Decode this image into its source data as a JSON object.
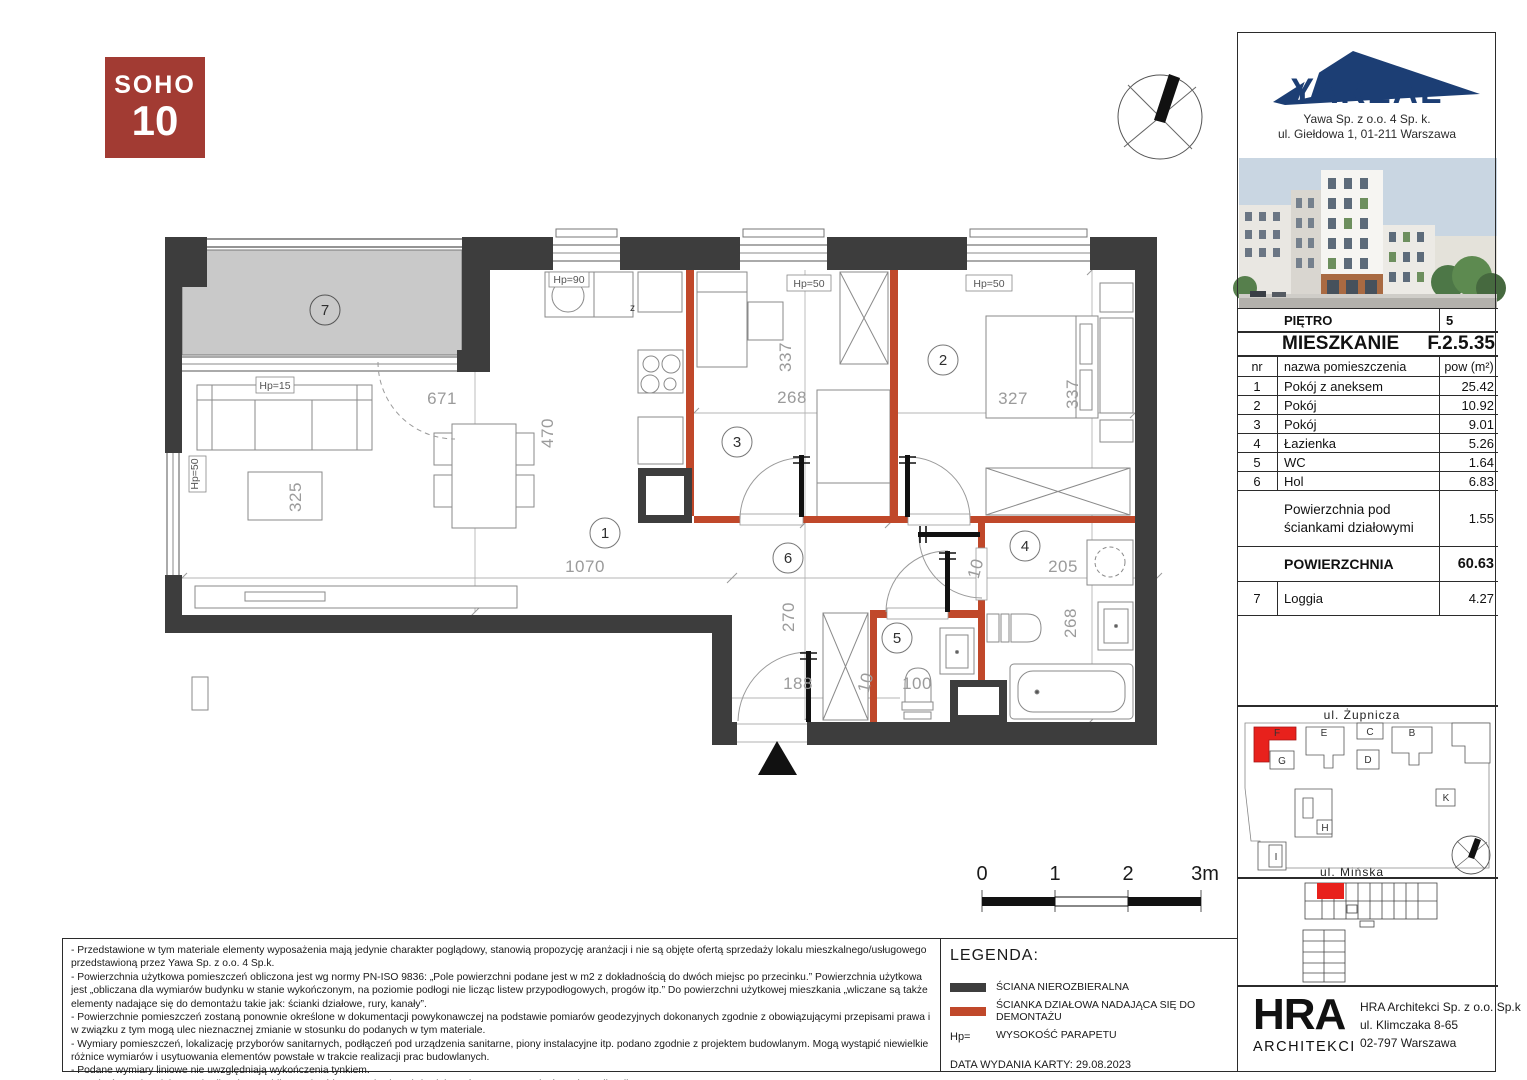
{
  "branding": {
    "soho_line1": "SOHO",
    "soho_line2": "10",
    "yareal": "YAREAL",
    "company": "Yawa Sp. z o.o. 4 Sp. k.",
    "address": "ul. Giełdowa 1,  01-211 Warszawa"
  },
  "unit_card": {
    "floor_label": "PIĘTRO",
    "floor": "5",
    "unit_label": "MIESZKANIE",
    "unit": "F.2.5.35",
    "columns": {
      "nr": "nr",
      "name": "nazwa pomieszczenia",
      "area": "pow (m²)"
    },
    "rooms": [
      {
        "nr": "1",
        "name": "Pokój z aneksem",
        "area": "25.42"
      },
      {
        "nr": "2",
        "name": "Pokój",
        "area": "10.92"
      },
      {
        "nr": "3",
        "name": "Pokój",
        "area": "9.01"
      },
      {
        "nr": "4",
        "name": "Łazienka",
        "area": "5.26"
      },
      {
        "nr": "5",
        "name": "WC",
        "area": "1.64"
      },
      {
        "nr": "6",
        "name": "Hol",
        "area": "6.83"
      }
    ],
    "partition_row": {
      "name": "Powierzchnia pod ściankami działowymi",
      "area": "1.55"
    },
    "total_row": {
      "label": "POWIERZCHNIA",
      "value": "60.63"
    },
    "loggia_row": {
      "nr": "7",
      "name": "Loggia",
      "area": "4.27"
    }
  },
  "plan": {
    "room_numbers": {
      "r1": "1",
      "r2": "2",
      "r3": "3",
      "r4": "4",
      "r5": "5",
      "r6": "6",
      "r7": "7"
    },
    "dims": {
      "d671": "671",
      "d470": "470",
      "d1070": "1070",
      "d325": "325",
      "d337a": "337",
      "d268a": "268",
      "d327": "327",
      "d337b": "337",
      "d205": "205",
      "d268b": "268",
      "d270": "270",
      "d188": "188",
      "d100": "100",
      "d10a": "10",
      "d10b": "10"
    },
    "hp": {
      "h15": "Hp=15",
      "h50l": "Hp=50",
      "h90": "Hp=90",
      "h50a": "Hp=50",
      "h50b": "Hp=50"
    },
    "kitchen_z": "z"
  },
  "scale_bar": {
    "t0": "0",
    "t1": "1",
    "t2": "2",
    "t3": "3m"
  },
  "site_plan": {
    "street_top": "ul.  Żupnicza",
    "street_bottom": "ul.  Mińska",
    "b_f": "F",
    "b_e": "E",
    "b_c": "C",
    "b_b": "B",
    "b_g": "G",
    "b_d": "D",
    "b_h": "H",
    "b_k": "K",
    "b_i": "I"
  },
  "legend": {
    "title": "LEGENDA:",
    "item_wall": "ŚCIANA NIEROZBIERALNA",
    "item_partition": "ŚCIANKA DZIAŁOWA NADAJĄCA SIĘ DO DEMONTAŻU",
    "item_hp_prefix": "Hp=",
    "item_hp": "WYSOKOŚĆ PARAPETU",
    "issue_date": "DATA WYDANIA KARTY: 29.08.2023"
  },
  "architect": {
    "logo_line1": "HRA",
    "logo_line2": "ARCHITEKCI",
    "name": "HRA Architekci Sp. z o.o. Sp.k",
    "street": "ul. Klimczaka 8-65",
    "city": "02-797 Warszawa"
  },
  "disclaimers": [
    "- Przedstawione w tym materiale elementy wyposażenia mają jedynie charakter poglądowy, stanowią propozycję aranżacji i nie są objęte ofertą sprzedaży lokalu mieszkalnego/usługowego przedstawioną przez Yawa Sp. z o.o. 4 Sp.k.",
    "- Powierzchnia użytkowa pomieszczeń obliczona jest wg normy PN-ISO 9836: „Pole powierzchni podane jest w m2 z dokładnością do dwóch miejsc po przecinku.” Powierzchnia użytkowa jest „obliczana dla wymiarów budynku w stanie wykończonym, na poziomie podłogi nie licząc listew przypodłogowych, progów itp.” Do powierzchni użytkowej mieszkania „wliczane są także elementy nadające się do demontażu takie jak: ścianki działowe, rury, kanały”.",
    "- Powierzchnie pomieszczeń zostaną ponownie określone w dokumentacji powykonawczej na podstawie pomiarów geodezyjnych dokonanych zgodnie z obowiązującymi przepisami prawa i w związku z tym mogą ulec nieznacznej zmianie w stosunku do podanych w tym materiale.",
    "- Wymiary pomieszczeń, lokalizację przyborów sanitarnych, podłączeń pod urządzenia sanitarne, piony instalacyjne itp. podano zgodnie z projektem budowlanym. Mogą wystąpić niewielkie różnice wymiarów i usytuowania elementów powstałe w trakcie realizacji prac budowlanych.",
    "- Podane wymiary liniowe nie uwzględniają wykończenia tynkiem.",
    "- Pomiarów pod projekt aranżacji, zakup mebli, urządzeń i wyposażenia należy dokonać z natury po zakończeniu realizacji."
  ],
  "colors": {
    "wall": "#3d3d3d",
    "partition": "#c0482a",
    "loggia_fill": "#c9c9c9",
    "soho_red": "#a23b33",
    "yareal_navy": "#1c3e74",
    "site_unit_red": "#e8211c"
  }
}
